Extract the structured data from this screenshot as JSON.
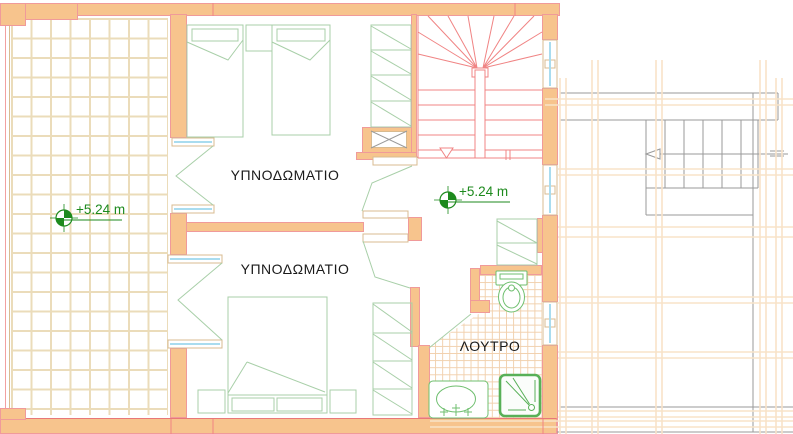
{
  "plan": {
    "title": "floor-plan-level-2",
    "rooms": [
      {
        "id": "bedroom-1",
        "label": "ΥΠΝΟΔΩΜΑΤΙΟ"
      },
      {
        "id": "bedroom-2",
        "label": "ΥΠΝΟΔΩΜΑΤΙΟ"
      },
      {
        "id": "bathroom",
        "label": "ΛΟΥΤΡΟ"
      }
    ],
    "elevation_markers": [
      {
        "id": "terrace-level",
        "text": "+5.24 m",
        "icon": "level-marker-icon"
      },
      {
        "id": "landing-level",
        "text": "+5.24 m",
        "icon": "level-marker-icon"
      }
    ],
    "symbols": [
      "staircase-up",
      "direction-arrow",
      "double-bed",
      "single-bed",
      "nightstand",
      "wardrobe-shelves",
      "linen-closet",
      "toilet",
      "washbasin",
      "shower-tray",
      "duct-shaft-x",
      "french-door",
      "window-glazing",
      "floor-tiles",
      "adjacent-stair"
    ],
    "colors": {
      "wall_fill": "#f7c48d",
      "wall_outline": "#f09a9a",
      "stair_red": "#f08484",
      "furniture_green": "#a8cfa8",
      "fixture_green": "#6fbf6f",
      "level_green": "#1d8a1d",
      "terrace_tile_line": "#ebdcba",
      "bath_tile_line": "#f1d0ad",
      "glazing_cyan": "#a9dcef",
      "frame_tan": "#d8bb90",
      "adjacent_gray": "#9a9a9a",
      "faint_orange": "#f8e3c8",
      "label_black": "#1a1a1a"
    }
  }
}
